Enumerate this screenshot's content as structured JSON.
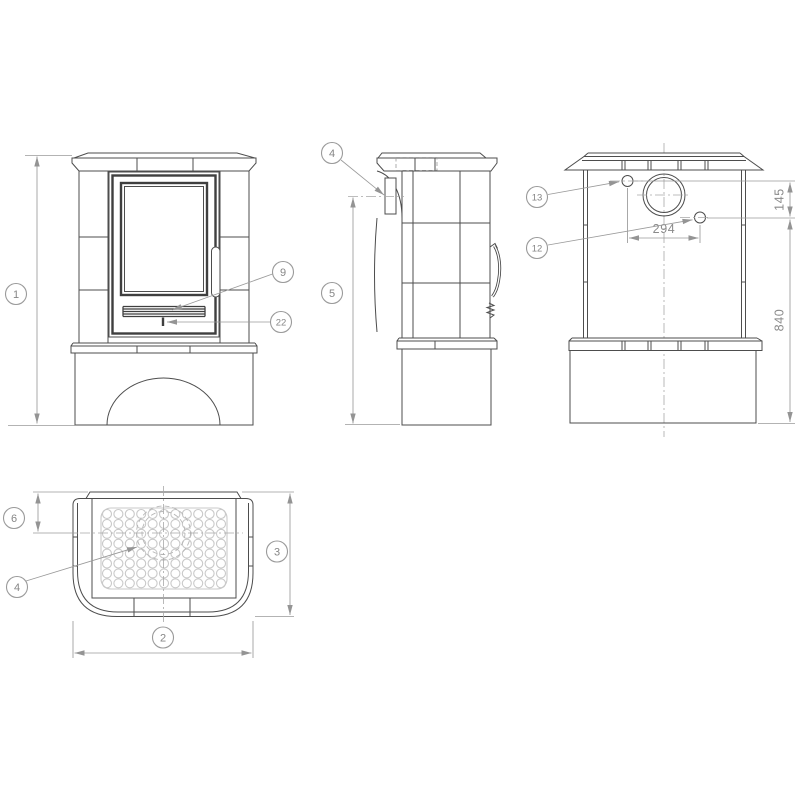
{
  "views": {
    "front": {
      "overall_height_balloon": "1",
      "grille_balloon": "9",
      "latch_balloon": "22"
    },
    "side": {
      "flue_collar_balloon": "4",
      "flue_height_balloon": "5"
    },
    "back": {
      "upper_hole_balloon": "13",
      "lower_hole_balloon": "12",
      "dim_hole_spacing_horizontal": "294",
      "dim_hole_offset_vertical": "145",
      "dim_hole_height_from_floor": "840"
    },
    "top": {
      "flue_offset_balloon": "6",
      "vent_plate_balloon": "4",
      "depth_balloon": "3",
      "width_balloon": "2"
    }
  }
}
